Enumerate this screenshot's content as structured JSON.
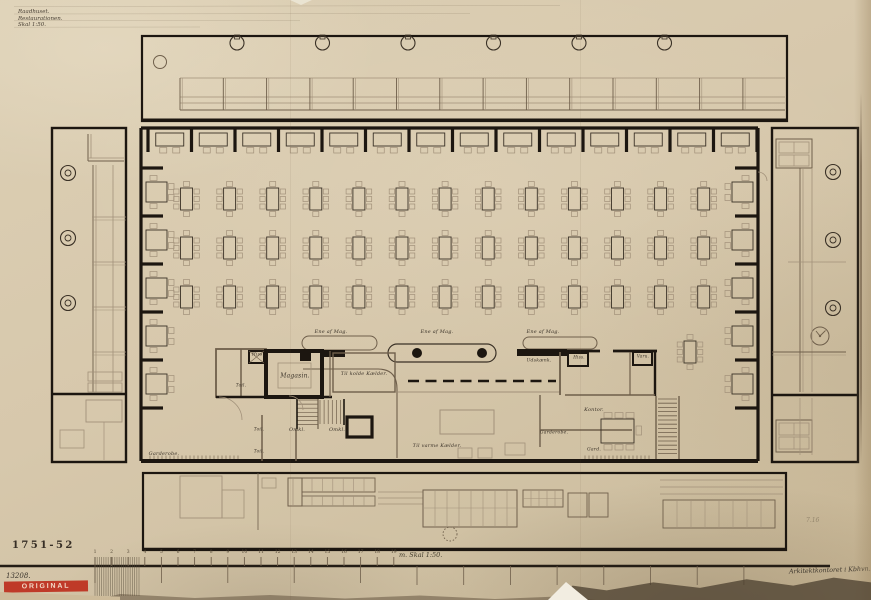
{
  "title_block": {
    "line1": "Raadhuset.",
    "line2": "Restaurationen.",
    "line3": "Skal 1:50."
  },
  "annotations": {
    "drawing_number": "1751-52",
    "inventory_number": "13208.",
    "stamp": "ORIGINAL",
    "signature": "Arkitektkontoret i Kbhvn.",
    "pencil_note": "7.16",
    "scale_caption": "m.  Skal 1:50."
  },
  "scale_numbers": [
    "1",
    "2",
    "3",
    "4",
    "5",
    "6",
    "7",
    "8",
    "9",
    "10",
    "11",
    "12",
    "13",
    "14",
    "15",
    "16",
    "17",
    "18",
    "19"
  ],
  "room_labels": {
    "hiss_left": "Hiss.",
    "magasin": "Magasin.",
    "til_kolde_kaelder": "Til kolde Kælder.",
    "toil_a": "Toil.",
    "toil_b": "Toil.",
    "toil_c": "Toil.",
    "omkl_a": "Omkl.",
    "omkl_b": "Omkl.",
    "garderobe_left": "Garderobe.",
    "til_varme_kaelder": "Til varme Kælder.",
    "ene_af_mag_1": "Ene af Mag.",
    "ene_af_mag_2": "Ene af Mag.",
    "ene_af_mag_3": "Ene af Mag.",
    "udskaenk": "Udskænk.",
    "hiss_right": "Hiss.",
    "varu_right": "Varu.",
    "kontor": "Kontor.",
    "garderobe_right": "Garderobe.",
    "gard_right": "Gard.",
    "colors_note": ""
  },
  "colors": {
    "paper": "#d6c7ab",
    "ink": "#3a3126",
    "wall_black": "#1c1610",
    "light_line": "#a2917a",
    "stamp_red": "#bf3a28"
  }
}
